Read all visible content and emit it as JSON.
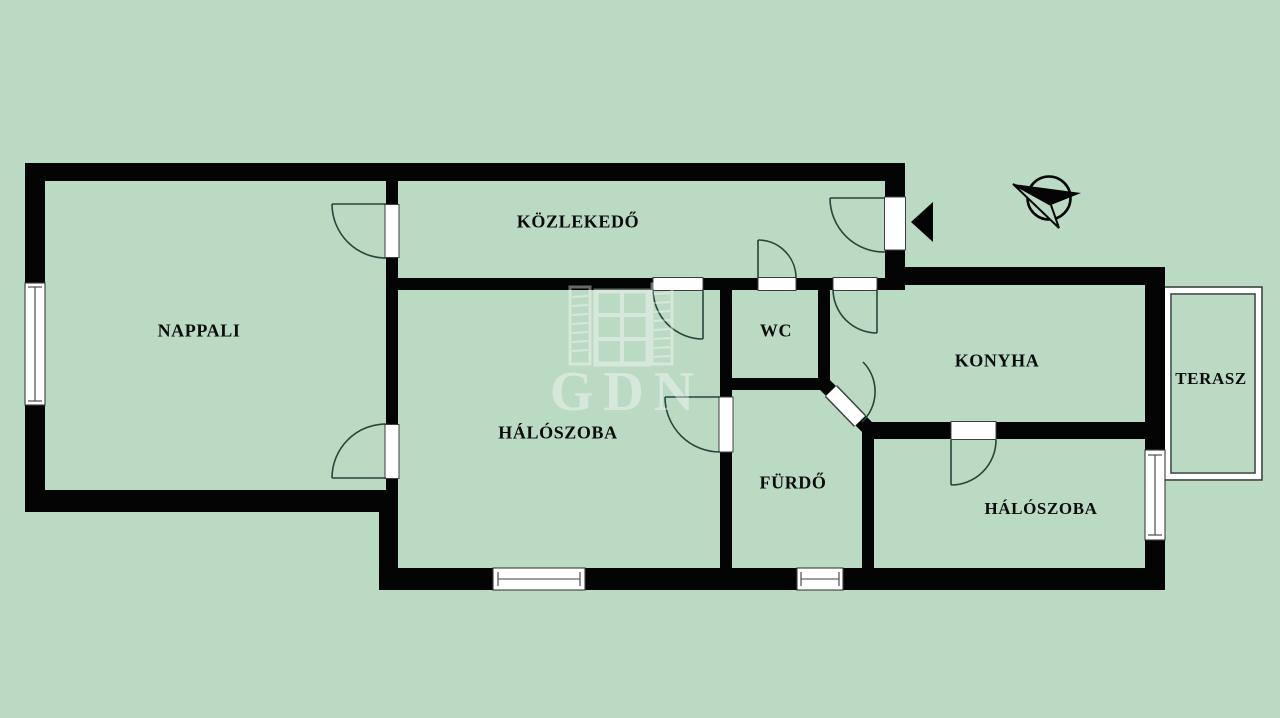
{
  "plan": {
    "type": "apartment-floor-plan",
    "language": "Hungarian"
  },
  "colors": {
    "background": "#bbdac3",
    "walls": "#040404",
    "door_arc": "#27453a",
    "window_line": "#3d3d3d",
    "terrace_line": "#333333",
    "watermark": "#ffffff"
  },
  "rooms": [
    {
      "id": "nappali",
      "label": "NAPPALI"
    },
    {
      "id": "kozlekedo",
      "label": "KÖZLEKEDŐ"
    },
    {
      "id": "wc",
      "label": "WC"
    },
    {
      "id": "konyha",
      "label": "KONYHA"
    },
    {
      "id": "terasz",
      "label": "TERASZ"
    },
    {
      "id": "haloszoba-1",
      "label": "HÁLÓSZOBA"
    },
    {
      "id": "furdo",
      "label": "FÜRDŐ"
    },
    {
      "id": "haloszoba-2",
      "label": "HÁLÓSZOBA"
    }
  ],
  "watermark": {
    "text": "GDN"
  },
  "icons": [
    {
      "id": "compass-icon"
    },
    {
      "id": "entrance-arrow-icon"
    }
  ]
}
